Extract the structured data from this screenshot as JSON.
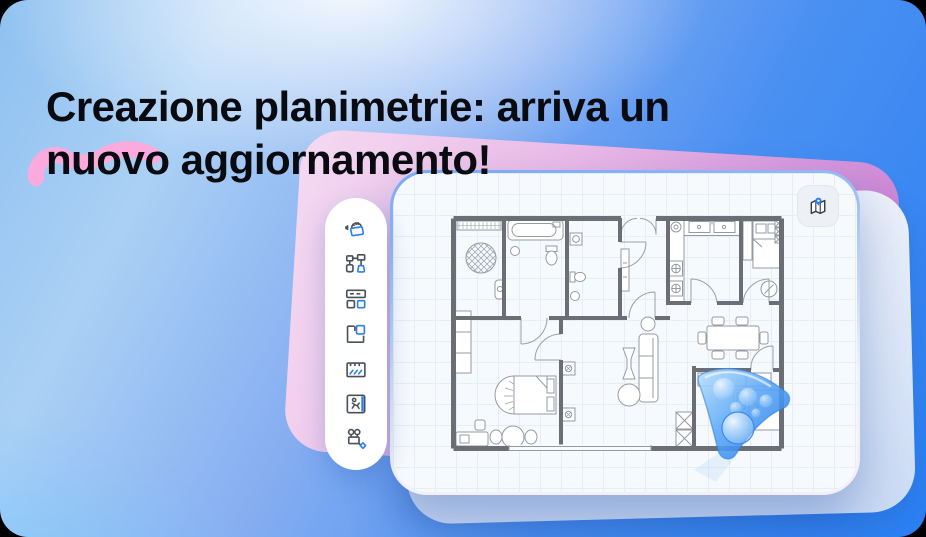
{
  "banner": {
    "title_line1": "Creazione planimetrie: arriva un",
    "title_line2": "nuovo aggiornamento!"
  },
  "toolbar": {
    "items": [
      {
        "name": "room-scan-icon"
      },
      {
        "name": "flowchart-shapes-icon"
      },
      {
        "name": "layout-blocks-icon"
      },
      {
        "name": "floor-plan-room-icon"
      },
      {
        "name": "flooring-hatch-icon"
      },
      {
        "name": "exit-route-icon"
      },
      {
        "name": "equipment-valves-icon"
      }
    ]
  },
  "canvas": {
    "map_button": {
      "icon": "map-location-icon"
    },
    "cursor": "glass-navigation-cursor",
    "content": "apartment-floor-plan"
  },
  "decorations": {
    "squiggle": "pink-squiggle"
  },
  "colors": {
    "accent_blue": "#2b7ff0",
    "vivid_blue": "#2f86f4",
    "light_blue": "#bcd9f8",
    "pink_squiggle": "#fbaade",
    "magenta_card": "#c97fd4",
    "title_text": "#0a0b10",
    "card_bg": "#f7fafd",
    "grid_line": "#e7edf6",
    "wall_gray": "#6b6f75"
  }
}
